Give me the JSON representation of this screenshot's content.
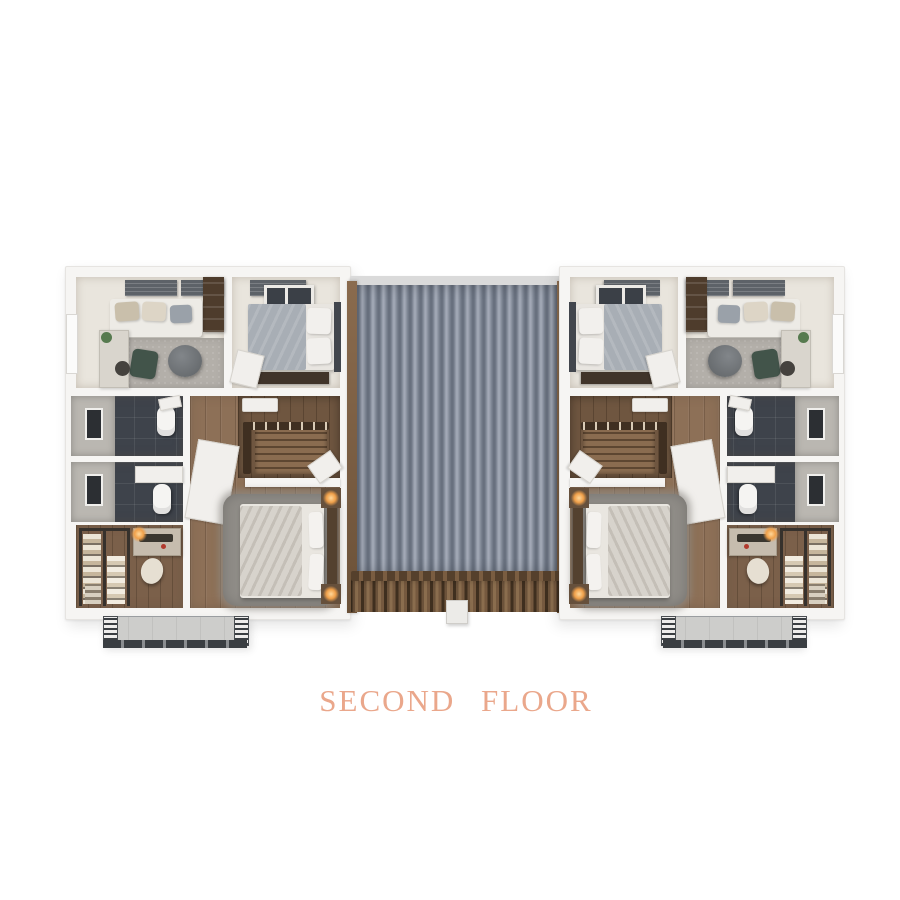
{
  "title": {
    "text": "SECOND FLOOR"
  },
  "floor_plan": {
    "units": [
      "left-unit",
      "right-unit"
    ],
    "rooms_per_unit": [
      "living-room",
      "bedroom",
      "bathroom-1",
      "bathroom-2",
      "stair-hall",
      "master-bedroom",
      "walk-in-closet",
      "balcony"
    ]
  },
  "colors": {
    "page_background": "#ffffff",
    "title_text": "#eaa78b",
    "wall_white": "#f6f5f3",
    "roof_metal_base": "#8a92a0",
    "roof_wood": "#6b523a",
    "wood_floor": "#8d7057",
    "closet_wood": "#7b604a",
    "bath_tile": "#3e434b",
    "concrete": "#bab7b1",
    "carpet": "#b3afa9",
    "rug_shag": "#8f8c87",
    "balcony_floor": "#cdcdcb",
    "lamp_glow": "#f0a04a"
  }
}
